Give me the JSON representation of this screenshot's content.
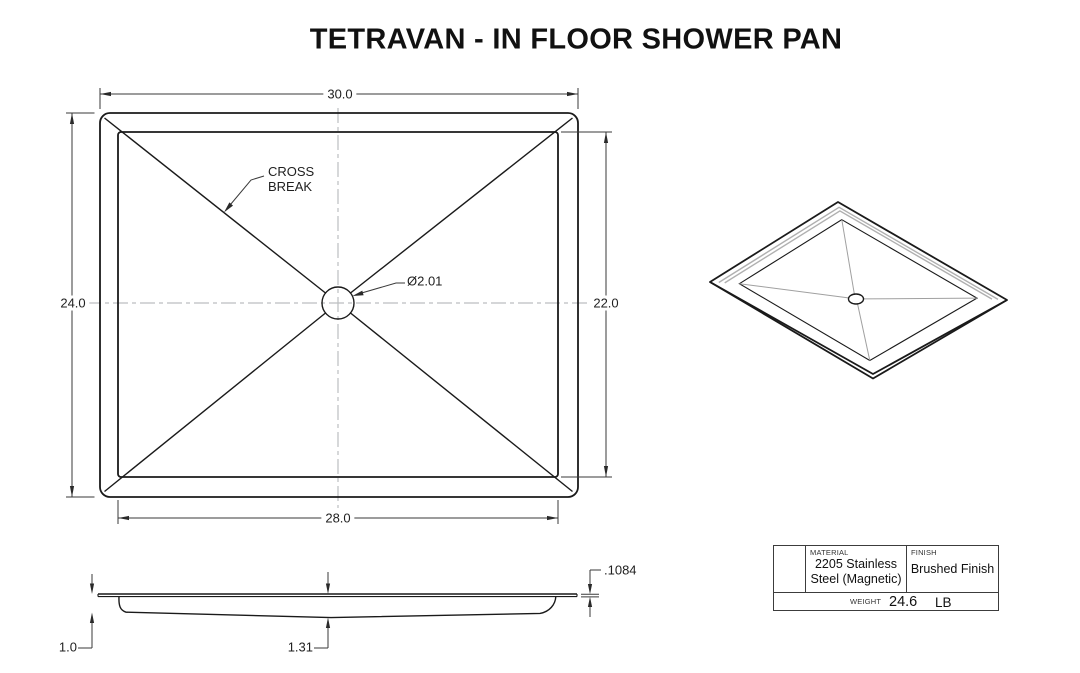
{
  "title": "TETRAVAN - IN FLOOR SHOWER PAN",
  "colors": {
    "object_line": "#1a1a1a",
    "dimension_line": "#3a3a3a",
    "centerline": "#bcbec0",
    "iso_highlight": "#b0b0b0",
    "background": "#ffffff"
  },
  "top_view": {
    "outer_width": "30.0",
    "outer_height": "24.0",
    "inner_height": "22.0",
    "inner_width": "28.0",
    "drain_diameter": "Ø2.01",
    "cross_break_label_line1": "CROSS",
    "cross_break_label_line2": "BREAK"
  },
  "side_view": {
    "edge_depth": "1.0",
    "center_depth": "1.31",
    "flange_thickness": ".1084"
  },
  "title_block": {
    "material_label": "MATERIAL",
    "material_line1": "2205 Stainless",
    "material_line2": "Steel (Magnetic)",
    "finish_label": "FINISH",
    "finish_value": "Brushed Finish",
    "weight_label": "WEIGHT",
    "weight_value": "24.6",
    "weight_unit": "LB"
  }
}
